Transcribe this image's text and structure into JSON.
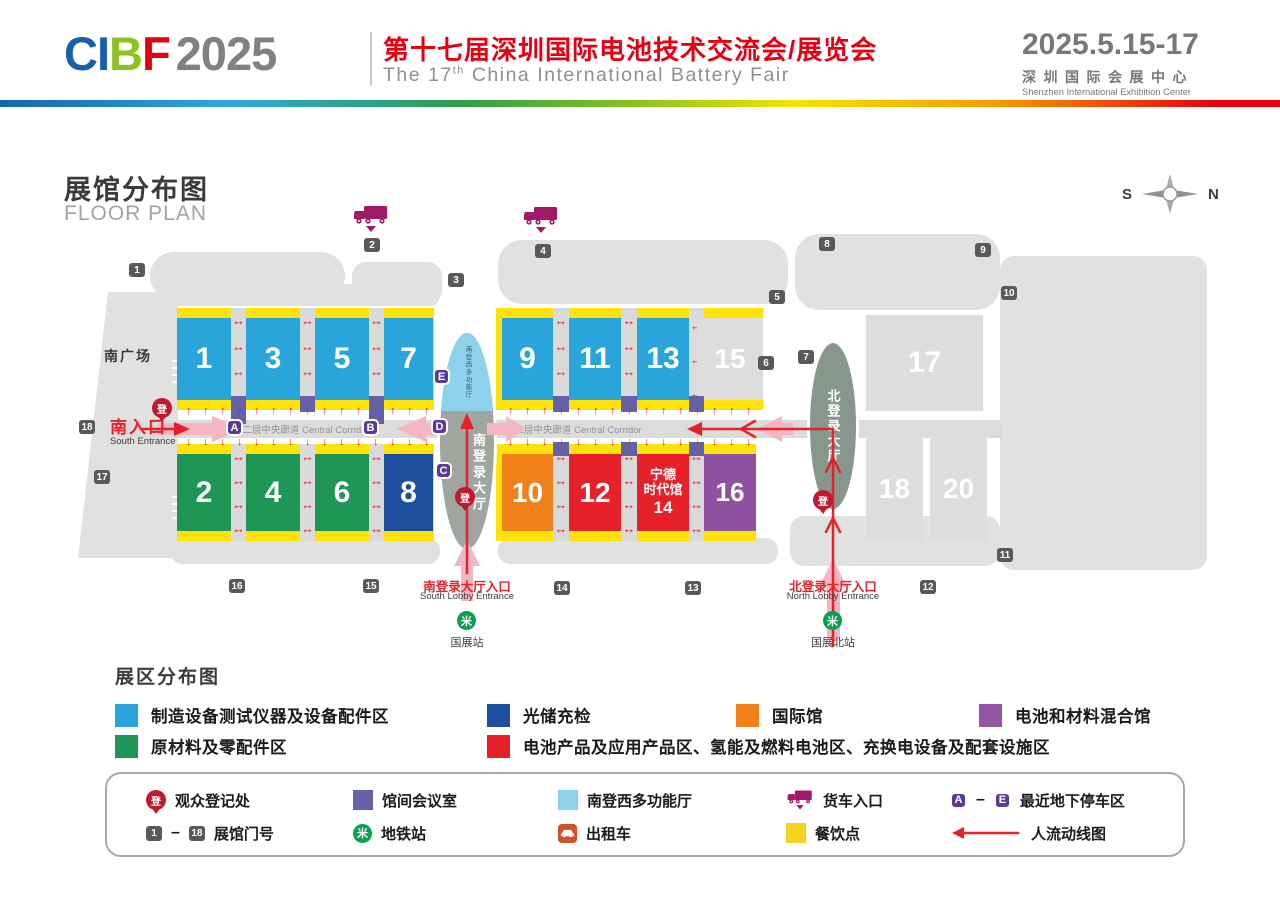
{
  "header": {
    "logo": {
      "c": "CI",
      "b": "B",
      "f": "F",
      "year": "2025"
    },
    "title_cn": "第十七届深圳国际电池技术交流会/展览会",
    "en1": "The 17",
    "en_sup": "th",
    "en2": " China International Battery Fair",
    "date": "2025.5.15-17",
    "venue_cn": "深圳国际会展中心",
    "venue_en": "Shenzhen International Exhibition Center"
  },
  "plan": {
    "title_cn": "展馆分布图",
    "title_en": "FLOOR PLAN",
    "compass_s": "S",
    "compass_n": "N",
    "south_plaza": "南广场",
    "corridor_label": "二层中央廊道 Central Corridor",
    "south_entrance_cn": "南入口",
    "south_entrance_en": "South Entrance",
    "south_lobby_name": "南登录大厅",
    "south_lobby_mfh": "南登西多功能厅",
    "north_lobby_name": "北登录大厅",
    "south_lobby_entrance_cn": "南登录大厅入口",
    "south_lobby_entrance_en": "South Lobby Entrance",
    "north_lobby_entrance_cn": "北登录大厅入口",
    "north_lobby_entrance_en": "North Lobby Entrance",
    "metro_south": "国展站",
    "metro_north": "国展北站",
    "reg_glyph": "登",
    "metro_glyph": "米",
    "halls": {
      "h1": "1",
      "h2": "2",
      "h3": "3",
      "h4": "4",
      "h5": "5",
      "h6": "6",
      "h7": "7",
      "h8": "8",
      "h9": "9",
      "h10": "10",
      "h11": "11",
      "h12": "12",
      "h13": "13",
      "h14_line1": "宁德",
      "h14_line2": "时代馆",
      "h14_line3": "14",
      "h15": "15",
      "h16": "16",
      "h17": "17",
      "h18": "18",
      "h20": "20"
    },
    "gates": [
      "1",
      "2",
      "3",
      "4",
      "5",
      "6",
      "7",
      "8",
      "9",
      "10",
      "11",
      "12",
      "13",
      "14",
      "15",
      "16",
      "17",
      "18"
    ],
    "parking": [
      "A",
      "B",
      "C",
      "D",
      "E"
    ],
    "colors": {
      "hall_blue": "#29A5DC",
      "hall_green": "#1F9656",
      "hall_navy": "#1C4E9D",
      "hall_orange": "#F08019",
      "hall_red": "#E62129",
      "hall_purple": "#8E52A1",
      "hall_gray": "#DCDEDC",
      "dining_yellow": "#FFE207",
      "meeting_purple": "#6561A9",
      "parking_purple": "#5B3A97",
      "accent_red": "#E60012",
      "flow_pink": "#F4B6C2"
    }
  },
  "zones": {
    "title": "展区分布图",
    "items": [
      {
        "color": "#29A5DC",
        "label": "制造设备测试仪器及设备配件区"
      },
      {
        "color": "#1C4E9D",
        "label": "光储充检"
      },
      {
        "color": "#F08019",
        "label": "国际馆"
      },
      {
        "color": "#9455A2",
        "label": "电池和材料混合馆"
      },
      {
        "color": "#1F9656",
        "label": "原材料及零配件区"
      },
      {
        "color": "#E62129",
        "label": "电池产品及应用产品区、氢能及燃料电池区、充换电设备及配套设施区"
      }
    ]
  },
  "fac": {
    "registration": "观众登记处",
    "meeting": "馆间会议室",
    "mfh": "南登西多功能厅",
    "truck": "货车入口",
    "parking_label": "最近地下停车区",
    "gate_label": "展馆门号",
    "metro": "地铁站",
    "taxi": "出租车",
    "dining": "餐饮点",
    "flow": "人流动线图",
    "dash": "–",
    "colors": {
      "meeting": "#6561A9",
      "mfh": "#8ED1EA",
      "dining": "#F5D31F"
    }
  }
}
